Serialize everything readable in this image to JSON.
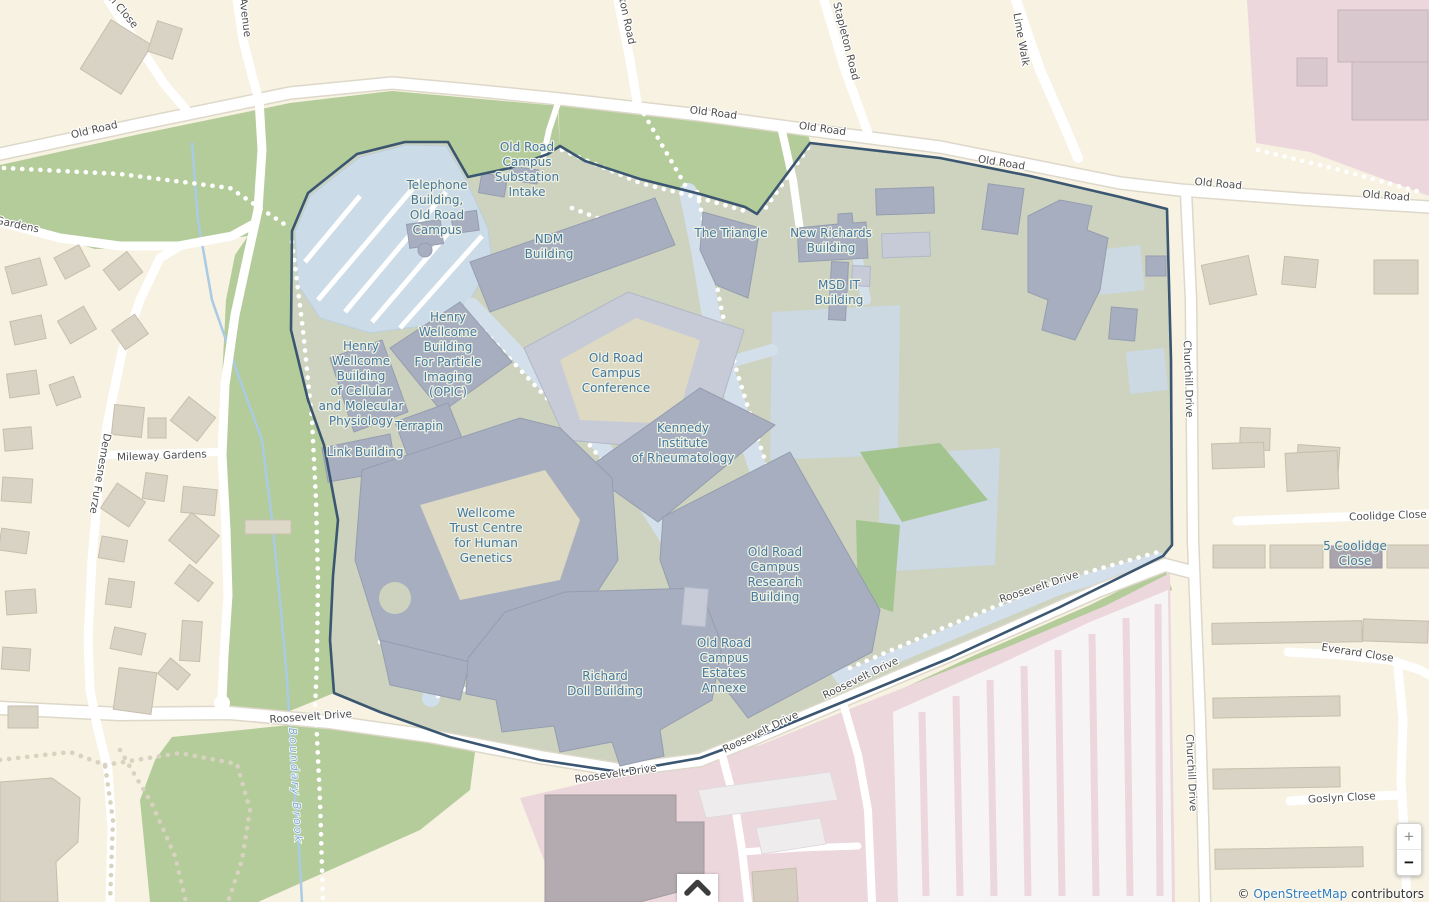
{
  "ui": {
    "attribution": {
      "copyright": "© ",
      "link_text": "OpenStreetMap",
      "suffix": " contributors"
    },
    "controls": {
      "zoom_in": "+",
      "zoom_out": "−"
    }
  },
  "colors": {
    "background_residential": "#f7f2e2",
    "grass_green": "#b4cb9a",
    "campus_fill": "#cdd3be",
    "campus_boundary": "#3a5670",
    "building_gray_blue": "#a6aebf",
    "parking_blue": "#cbdbe7",
    "hospital_pink": "#ecd7dd",
    "poi_label_blue": "#44789f",
    "road_label_gray": "#4e4e4e",
    "water_blue": "#a9cbe4",
    "link_blue": "#2e7cbd"
  },
  "map_labels": {
    "poi": [
      {
        "t": "Telephone\nBuilding,\nOld Road\nCampus",
        "x": 437,
        "y": 189,
        "r": 0
      },
      {
        "t": "Old Road\nCampus\nSubstation\nIntake",
        "x": 527,
        "y": 151,
        "r": 0
      },
      {
        "t": "NDM\nBuilding",
        "x": 549,
        "y": 243,
        "r": 0
      },
      {
        "t": "The Triangle",
        "x": 731,
        "y": 237,
        "r": 0
      },
      {
        "t": "New Richards\nBuilding",
        "x": 831,
        "y": 237,
        "r": 0
      },
      {
        "t": "MSD IT\nBuilding",
        "x": 839,
        "y": 289,
        "r": 0
      },
      {
        "t": "Henry\nWellcome\nBuilding\nFor Particle\nImaging\n(OPIC)",
        "x": 448,
        "y": 321,
        "r": 0
      },
      {
        "t": "Henry\nWellcome\nBuilding\nof Cellular\nand Molecular\nPhysiology",
        "x": 361,
        "y": 350,
        "r": 0
      },
      {
        "t": "Terrapin",
        "x": 419,
        "y": 430,
        "r": 0
      },
      {
        "t": "Link Building",
        "x": 365,
        "y": 456,
        "r": 0
      },
      {
        "t": "Old Road\nCampus\nConference",
        "x": 616,
        "y": 362,
        "r": 0
      },
      {
        "t": "Kennedy\nInstitute\nof Rheumatology",
        "x": 683,
        "y": 432,
        "r": 0
      },
      {
        "t": "Wellcome\nTrust Centre\nfor Human\nGenetics",
        "x": 486,
        "y": 517,
        "r": 0
      },
      {
        "t": "Old Road\nCampus\nResearch\nBuilding",
        "x": 775,
        "y": 556,
        "r": 0
      },
      {
        "t": "Richard\nDoll Building",
        "x": 605,
        "y": 680,
        "r": 0
      },
      {
        "t": "Old Road\nCampus\nEstates\nAnnexe",
        "x": 724,
        "y": 647,
        "r": 0
      },
      {
        "t": "5 Coolidge\nClose",
        "x": 1355,
        "y": 550,
        "r": 0
      }
    ],
    "road": [
      {
        "t": "Old Road",
        "x": 95,
        "y": 133,
        "r": -13
      },
      {
        "t": "Old Road",
        "x": 713,
        "y": 116,
        "r": 7
      },
      {
        "t": "Old Road",
        "x": 822,
        "y": 132,
        "r": 8
      },
      {
        "t": "Old Road",
        "x": 1001,
        "y": 166,
        "r": 9
      },
      {
        "t": "Old Road",
        "x": 1218,
        "y": 187,
        "r": 5
      },
      {
        "t": "Old Road",
        "x": 1386,
        "y": 199,
        "r": 4
      },
      {
        "t": "h Close",
        "x": 121,
        "y": 14,
        "r": 50
      },
      {
        "t": "Avenue",
        "x": 242,
        "y": 18,
        "r": 83
      },
      {
        "t": "ton Road",
        "x": 624,
        "y": 22,
        "r": 78
      },
      {
        "t": "Stapleton Road",
        "x": 843,
        "y": 42,
        "r": 76
      },
      {
        "t": "Lime Walk",
        "x": 1018,
        "y": 40,
        "r": 80
      },
      {
        "t": "y Gardens",
        "x": 12,
        "y": 227,
        "r": 12
      },
      {
        "t": "Mileway Gardens",
        "x": 162,
        "y": 459,
        "r": -2
      },
      {
        "t": "Demesne Furze",
        "x": 97,
        "y": 473,
        "r": 100
      },
      {
        "t": "Churchill Drive",
        "x": 1185,
        "y": 379,
        "r": 88
      },
      {
        "t": "Churchill Drive",
        "x": 1188,
        "y": 773,
        "r": 87
      },
      {
        "t": "Coolidge Close",
        "x": 1388,
        "y": 519,
        "r": -2
      },
      {
        "t": "Everard Close",
        "x": 1357,
        "y": 656,
        "r": 9
      },
      {
        "t": "Goslyn Close",
        "x": 1342,
        "y": 801,
        "r": -3
      },
      {
        "t": "Roosevelt Drive",
        "x": 311,
        "y": 720,
        "r": -4
      },
      {
        "t": "Roosevelt Drive",
        "x": 616,
        "y": 777,
        "r": -8
      },
      {
        "t": "Roosevelt Drive",
        "x": 762,
        "y": 735,
        "r": -26
      },
      {
        "t": "Roosevelt Drive",
        "x": 862,
        "y": 681,
        "r": -26
      },
      {
        "t": "Roosevelt Drive",
        "x": 1040,
        "y": 590,
        "r": -18
      }
    ],
    "water": [
      {
        "t": "Boundary Brook",
        "x": 292,
        "y": 786,
        "r": 87
      }
    ]
  }
}
